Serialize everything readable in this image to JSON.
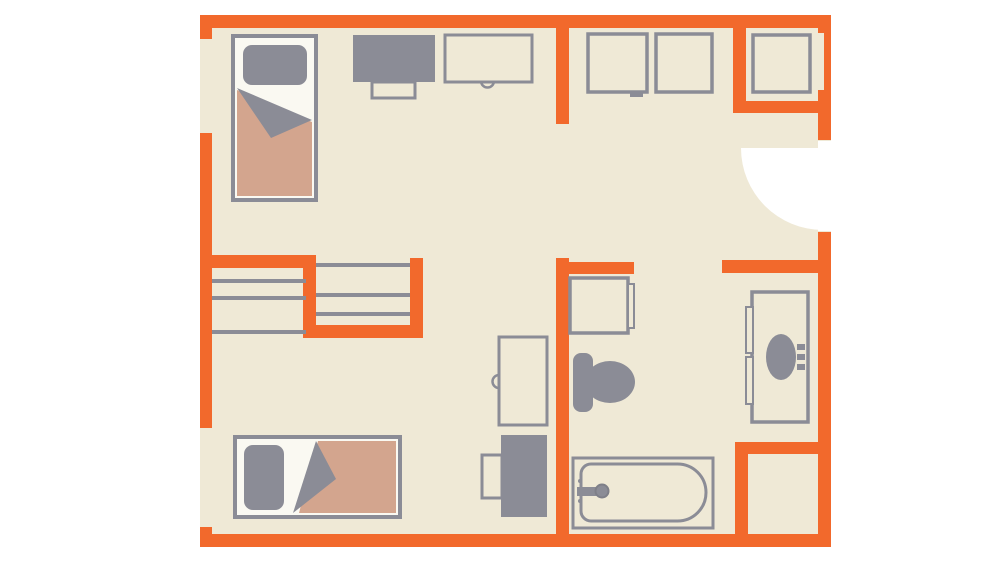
{
  "colors": {
    "wall": "#F2692C",
    "floor": "#EFE9D6",
    "gray": "#8B8C96",
    "tan": "#D3A58E",
    "sheet": "#FAF9F2",
    "background": "#FFFFFF",
    "knob": "#7E7F88",
    "none": "none"
  },
  "floorplan": {
    "canvas": {
      "width": 1000,
      "height": 563
    },
    "shapes": [
      {
        "name": "floor",
        "type": "rect",
        "x": 200,
        "y": 15,
        "w": 631,
        "h": 532,
        "fill": "floor"
      },
      {
        "name": "entry-door-swing",
        "type": "path",
        "d": "M 823 148 L 741 148 A 82 82 0 0 0 823 230 Z",
        "fill": "background"
      },
      {
        "name": "entry-door-opening",
        "type": "rect",
        "x": 818,
        "y": 141,
        "w": 13,
        "h": 90,
        "fill": "background"
      },
      {
        "name": "wall-top",
        "type": "rect",
        "x": 200,
        "y": 15,
        "w": 631,
        "h": 13,
        "fill": "wall"
      },
      {
        "name": "wall-left-door-jamb-upper",
        "type": "rect",
        "x": 200,
        "y": 28,
        "w": 12,
        "h": 11,
        "fill": "wall"
      },
      {
        "name": "wall-left-main",
        "type": "rect",
        "x": 200,
        "y": 133,
        "w": 12,
        "h": 295,
        "fill": "wall"
      },
      {
        "name": "wall-left-door-jamb-lower",
        "type": "rect",
        "x": 200,
        "y": 527,
        "w": 12,
        "h": 12,
        "fill": "wall"
      },
      {
        "name": "wall-bottom",
        "type": "rect",
        "x": 200,
        "y": 534,
        "w": 631,
        "h": 13,
        "fill": "wall"
      },
      {
        "name": "wall-right-upper",
        "type": "rect",
        "x": 818,
        "y": 15,
        "w": 13,
        "h": 125,
        "fill": "wall"
      },
      {
        "name": "wall-right-lower",
        "type": "rect",
        "x": 818,
        "y": 232,
        "w": 13,
        "h": 315,
        "fill": "wall"
      },
      {
        "name": "window-notch",
        "type": "rect",
        "x": 818,
        "y": 33,
        "w": 6,
        "h": 57,
        "fill": "floor"
      },
      {
        "name": "wall-bedroom-east",
        "type": "rect",
        "x": 556,
        "y": 28,
        "w": 13,
        "h": 96,
        "fill": "wall"
      },
      {
        "name": "wall-bathroom-west",
        "type": "rect",
        "x": 556,
        "y": 258,
        "w": 13,
        "h": 289,
        "fill": "wall"
      },
      {
        "name": "wall-closet-north",
        "type": "rect",
        "x": 200,
        "y": 255,
        "w": 116,
        "h": 13,
        "fill": "wall"
      },
      {
        "name": "wall-closet-divider",
        "type": "rect",
        "x": 303,
        "y": 255,
        "w": 13,
        "h": 83,
        "fill": "wall"
      },
      {
        "name": "wall-closet-south",
        "type": "rect",
        "x": 303,
        "y": 325,
        "w": 120,
        "h": 13,
        "fill": "wall"
      },
      {
        "name": "wall-closet-east",
        "type": "rect",
        "x": 410,
        "y": 258,
        "w": 13,
        "h": 80,
        "fill": "wall"
      },
      {
        "name": "wall-bathroom-north-stub",
        "type": "rect",
        "x": 556,
        "y": 262,
        "w": 78,
        "h": 12,
        "fill": "wall"
      },
      {
        "name": "wall-entry-south",
        "type": "rect",
        "x": 722,
        "y": 260,
        "w": 109,
        "h": 13,
        "fill": "wall"
      },
      {
        "name": "wall-hall-closet-west",
        "type": "rect",
        "x": 733,
        "y": 15,
        "w": 13,
        "h": 98,
        "fill": "wall"
      },
      {
        "name": "wall-hall-closet-south",
        "type": "rect",
        "x": 733,
        "y": 101,
        "w": 98,
        "h": 12,
        "fill": "wall"
      },
      {
        "name": "wall-shaft-north",
        "type": "rect",
        "x": 735,
        "y": 442,
        "w": 96,
        "h": 12,
        "fill": "wall"
      },
      {
        "name": "wall-shaft-west",
        "type": "rect",
        "x": 735,
        "y": 442,
        "w": 13,
        "h": 105,
        "fill": "wall"
      },
      {
        "name": "closet-shelf-left-1",
        "type": "rect",
        "x": 212,
        "y": 279,
        "w": 94,
        "h": 4,
        "fill": "gray"
      },
      {
        "name": "closet-shelf-left-2",
        "type": "rect",
        "x": 212,
        "y": 296,
        "w": 94,
        "h": 4,
        "fill": "gray"
      },
      {
        "name": "closet-shelf-left-3",
        "type": "rect",
        "x": 212,
        "y": 330,
        "w": 94,
        "h": 4,
        "fill": "gray"
      },
      {
        "name": "closet-shelf-right-1",
        "type": "rect",
        "x": 316,
        "y": 263,
        "w": 94,
        "h": 4,
        "fill": "gray"
      },
      {
        "name": "closet-shelf-right-2",
        "type": "rect",
        "x": 316,
        "y": 293,
        "w": 94,
        "h": 4,
        "fill": "gray"
      },
      {
        "name": "closet-shelf-right-3",
        "type": "rect",
        "x": 316,
        "y": 312,
        "w": 94,
        "h": 4,
        "fill": "gray"
      },
      {
        "name": "bed-1-frame",
        "type": "rect",
        "x": 233,
        "y": 36,
        "w": 83,
        "h": 164,
        "fill": "sheet",
        "stroke": "gray",
        "sw": 4
      },
      {
        "name": "bed-1-blanket",
        "type": "polygon",
        "points": "237,90 312,122 312,196 237,196",
        "fill": "tan"
      },
      {
        "name": "bed-1-fold",
        "type": "polygon",
        "points": "237,88 312,120 271,138",
        "fill": "gray"
      },
      {
        "name": "bed-1-pillow",
        "type": "rect",
        "x": 243,
        "y": 45,
        "w": 64,
        "h": 40,
        "rx": 9,
        "fill": "gray"
      },
      {
        "name": "dresser-top",
        "type": "rect",
        "x": 353,
        "y": 35,
        "w": 82,
        "h": 47,
        "fill": "gray"
      },
      {
        "name": "dresser-stool",
        "type": "rect",
        "x": 372,
        "y": 82,
        "w": 43,
        "h": 16,
        "fill": "floor",
        "stroke": "gray",
        "sw": 3
      },
      {
        "name": "desk-1-grommet",
        "type": "path",
        "d": "M 481 81 A 6.5 6.5 0 0 0 494 81",
        "fill": "floor",
        "stroke": "gray",
        "sw": 2.5
      },
      {
        "name": "desk-1",
        "type": "rect",
        "x": 445,
        "y": 35,
        "w": 87,
        "h": 47,
        "fill": "floor",
        "stroke": "gray",
        "sw": 3
      },
      {
        "name": "cabinet-1",
        "type": "rect",
        "x": 588,
        "y": 34,
        "w": 59,
        "h": 58,
        "fill": "floor",
        "stroke": "gray",
        "sw": 3.5
      },
      {
        "name": "cabinet-1-latch",
        "type": "rect",
        "x": 630,
        "y": 92,
        "w": 13,
        "h": 5,
        "fill": "gray"
      },
      {
        "name": "cabinet-2",
        "type": "rect",
        "x": 656,
        "y": 34,
        "w": 56,
        "h": 58,
        "fill": "floor",
        "stroke": "gray",
        "sw": 3.5
      },
      {
        "name": "hall-closet-unit",
        "type": "rect",
        "x": 753,
        "y": 35,
        "w": 57,
        "h": 57,
        "fill": "floor",
        "stroke": "gray",
        "sw": 3.5
      },
      {
        "name": "desk-2-grommet",
        "type": "path",
        "d": "M 499 375 A 6.5 6.5 0 0 0 499 388",
        "fill": "floor",
        "stroke": "gray",
        "sw": 2.5
      },
      {
        "name": "desk-2",
        "type": "rect",
        "x": 499,
        "y": 337,
        "w": 48,
        "h": 88,
        "fill": "floor",
        "stroke": "gray",
        "sw": 3
      },
      {
        "name": "desk-2-chair",
        "type": "rect",
        "x": 482,
        "y": 455,
        "w": 20,
        "h": 43,
        "fill": "floor",
        "stroke": "gray",
        "sw": 3
      },
      {
        "name": "dresser-2",
        "type": "rect",
        "x": 501,
        "y": 435,
        "w": 46,
        "h": 82,
        "fill": "gray"
      },
      {
        "name": "bed-2-frame",
        "type": "rect",
        "x": 235,
        "y": 437,
        "w": 165,
        "h": 80,
        "fill": "sheet",
        "stroke": "gray",
        "sw": 4
      },
      {
        "name": "bed-2-blanket",
        "type": "polygon",
        "points": "318,441 396,441 396,513 299,513",
        "fill": "tan"
      },
      {
        "name": "bed-2-fold",
        "type": "polygon",
        "points": "316,441 336,479 293,513",
        "fill": "gray"
      },
      {
        "name": "bed-2-pillow",
        "type": "rect",
        "x": 244,
        "y": 445,
        "w": 40,
        "h": 65,
        "rx": 9,
        "fill": "gray"
      },
      {
        "name": "washer",
        "type": "rect",
        "x": 570,
        "y": 278,
        "w": 58,
        "h": 55,
        "fill": "floor",
        "stroke": "gray",
        "sw": 3.5
      },
      {
        "name": "washer-door",
        "type": "rect",
        "x": 628,
        "y": 284,
        "w": 6,
        "h": 44,
        "fill": "floor",
        "stroke": "gray",
        "sw": 2
      },
      {
        "name": "toilet-tank",
        "type": "rect",
        "x": 573,
        "y": 353,
        "w": 20,
        "h": 59,
        "rx": 8,
        "fill": "gray"
      },
      {
        "name": "toilet-bowl",
        "type": "ellipse",
        "cx": 610,
        "cy": 382,
        "rx": 25,
        "ry": 21,
        "fill": "gray"
      },
      {
        "name": "vanity",
        "type": "rect",
        "x": 752,
        "y": 292,
        "w": 56,
        "h": 130,
        "fill": "floor",
        "stroke": "gray",
        "sw": 3.5
      },
      {
        "name": "vanity-door-upper",
        "type": "rect",
        "x": 746,
        "y": 307,
        "w": 7,
        "h": 46,
        "fill": "floor",
        "stroke": "gray",
        "sw": 2
      },
      {
        "name": "vanity-door-lower",
        "type": "rect",
        "x": 746,
        "y": 357,
        "w": 7,
        "h": 47,
        "fill": "floor",
        "stroke": "gray",
        "sw": 2
      },
      {
        "name": "sink-basin",
        "type": "ellipse",
        "cx": 781,
        "cy": 357,
        "rx": 15,
        "ry": 23,
        "fill": "gray"
      },
      {
        "name": "sink-faucet-1",
        "type": "rect",
        "x": 797,
        "y": 344,
        "w": 8,
        "h": 6,
        "fill": "gray"
      },
      {
        "name": "sink-faucet-2",
        "type": "rect",
        "x": 797,
        "y": 354,
        "w": 8,
        "h": 6,
        "fill": "gray"
      },
      {
        "name": "sink-faucet-3",
        "type": "rect",
        "x": 797,
        "y": 364,
        "w": 8,
        "h": 6,
        "fill": "gray"
      },
      {
        "name": "bathtub-outer",
        "type": "rect",
        "x": 573,
        "y": 458,
        "w": 140,
        "h": 70,
        "fill": "floor",
        "stroke": "gray",
        "sw": 3
      },
      {
        "name": "bathtub-inner",
        "type": "path",
        "d": "M 591 464 H 677.5 A 28.5 28.5 0 0 1 677.5 521 H 591 A 10 10 0 0 1 581 511 V 474 A 10 10 0 0 1 591 464 Z",
        "fill": "none",
        "stroke": "gray",
        "sw": 3
      },
      {
        "name": "bathtub-faucet",
        "type": "rect",
        "x": 577,
        "y": 487,
        "w": 20,
        "h": 9,
        "fill": "gray"
      },
      {
        "name": "bathtub-knob",
        "type": "ellipse",
        "cx": 602,
        "cy": 491,
        "rx": 6.5,
        "ry": 6.5,
        "fill": "gray",
        "stroke": "knob",
        "sw": 2
      },
      {
        "name": "bathtub-dot-upper",
        "type": "ellipse",
        "cx": 580,
        "cy": 481,
        "rx": 2,
        "ry": 2,
        "fill": "gray"
      },
      {
        "name": "bathtub-dot-lower",
        "type": "ellipse",
        "cx": 580,
        "cy": 501,
        "rx": 2,
        "ry": 2,
        "fill": "gray"
      }
    ]
  }
}
